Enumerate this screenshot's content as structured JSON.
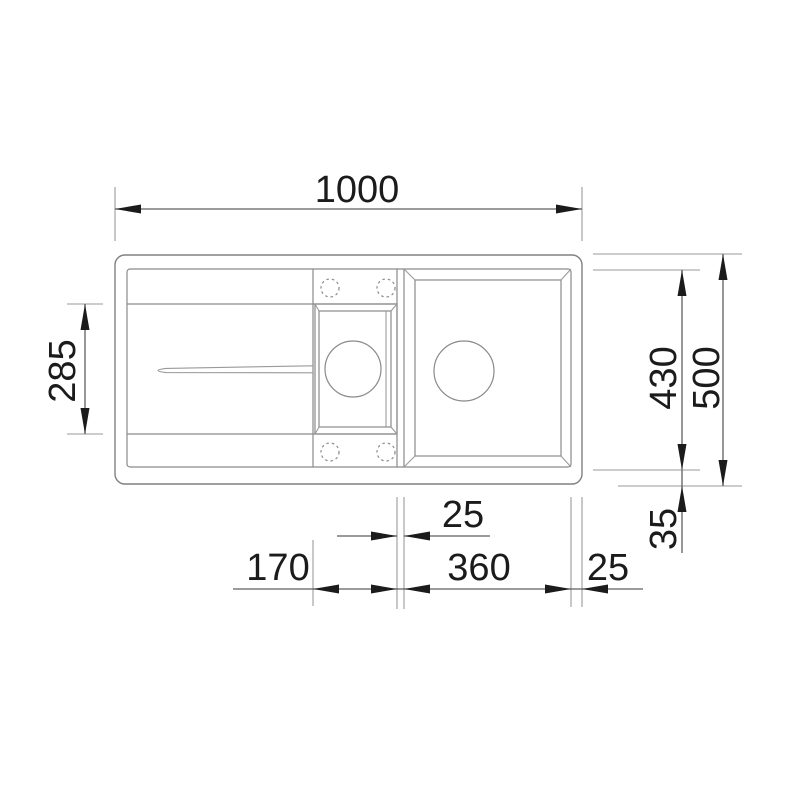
{
  "drawing": {
    "type": "technical-dimension-drawing",
    "subject": "inset kitchen sink plan view, 1.5 bowls with drainboard",
    "units": "mm",
    "dimensions": {
      "overall_width": "1000",
      "overall_depth": "500",
      "main_bowl_depth": "430",
      "drainer_recess_depth": "285",
      "bowl_to_bottom_edge": "35",
      "bowl_gap": "25",
      "small_bowl_width": "170",
      "main_bowl_width": "360",
      "bowl_to_right_edge": "25"
    },
    "colors": {
      "background": "#ffffff",
      "sink_line": "#808080",
      "extension_line": "#9a9a9a",
      "dimension_line": "#5f5f5f",
      "arrow_and_text": "#1b1b1b"
    }
  }
}
